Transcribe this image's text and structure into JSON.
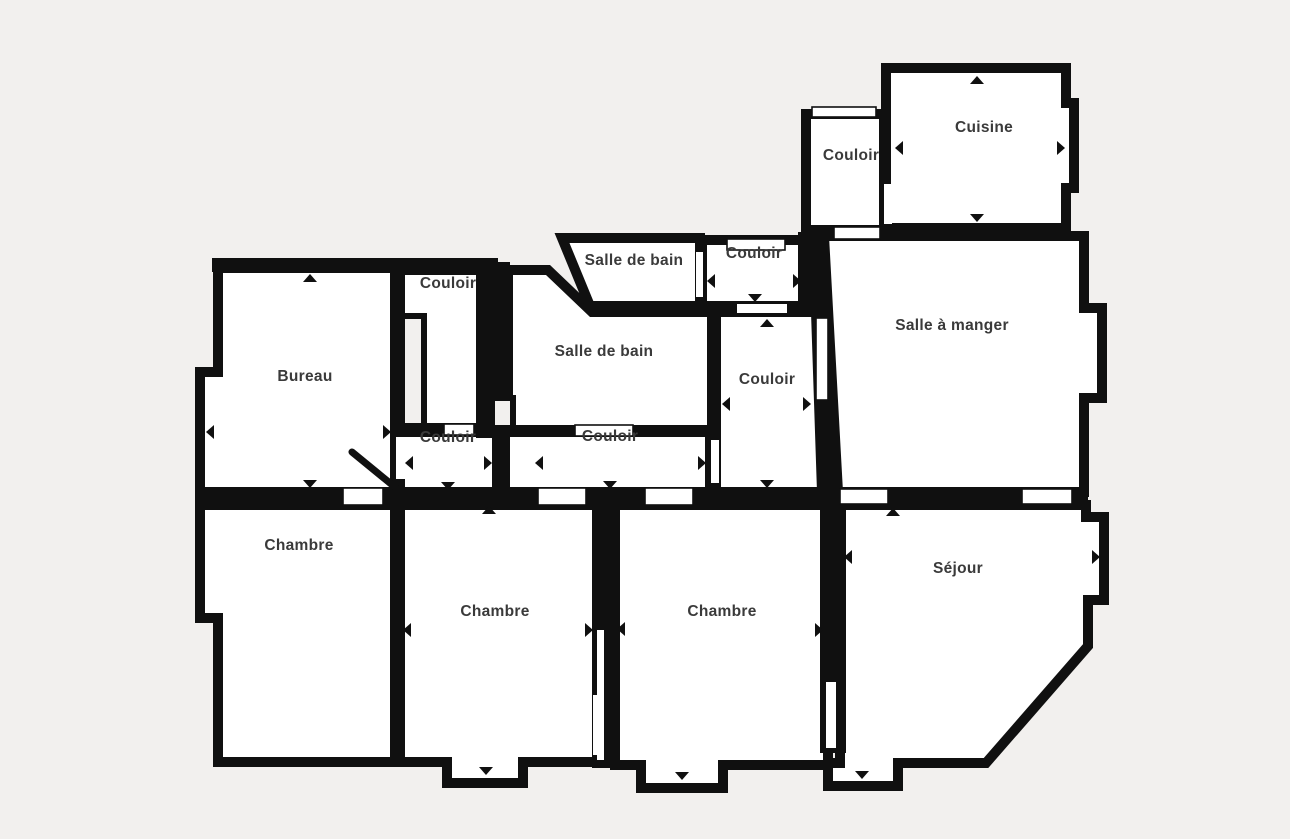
{
  "meta": {
    "app": "floor-plan-viewer",
    "plan_title": "Plan d'appartement"
  },
  "canvas": {
    "width": 1290,
    "height": 839,
    "bg_color": "#f2f0ee",
    "wall_color": "#101010",
    "room_fill": "#ffffff",
    "label_color": "#3a3a3a",
    "label_font_size": 15.5
  },
  "rooms": [
    {
      "id": "bureau",
      "label": "Bureau",
      "label_x": 305,
      "label_y": 377,
      "points": [
        [
          218,
          268
        ],
        [
          395,
          268
        ],
        [
          395,
          492
        ],
        [
          200,
          492
        ],
        [
          200,
          372
        ],
        [
          218,
          372
        ]
      ]
    },
    {
      "id": "couloir-topleft",
      "label": "Couloir",
      "label_x": 448,
      "label_y": 284,
      "points": [
        [
          400,
          270
        ],
        [
          483,
          270
        ],
        [
          483,
          428
        ],
        [
          400,
          428
        ]
      ]
    },
    {
      "id": "couloir-lower-left",
      "label": "Couloir",
      "label_x": 448,
      "label_y": 438,
      "points": [
        [
          400,
          432
        ],
        [
          497,
          432
        ],
        [
          497,
          492
        ],
        [
          400,
          492
        ]
      ]
    },
    {
      "id": "salle-de-bain-grande",
      "label": "Salle de bain",
      "label_x": 604,
      "label_y": 352,
      "points": [
        [
          508,
          270
        ],
        [
          548,
          270
        ],
        [
          592,
          312
        ],
        [
          712,
          312
        ],
        [
          712,
          430
        ],
        [
          508,
          430
        ]
      ]
    },
    {
      "id": "couloir-central",
      "label": "Couloir",
      "label_x": 610,
      "label_y": 437,
      "points": [
        [
          505,
          432
        ],
        [
          710,
          432
        ],
        [
          710,
          492
        ],
        [
          505,
          492
        ]
      ]
    },
    {
      "id": "salle-de-bain-petite",
      "label": "Salle de bain",
      "label_x": 634,
      "label_y": 261,
      "points": [
        [
          562,
          238
        ],
        [
          700,
          238
        ],
        [
          700,
          306
        ],
        [
          590,
          306
        ]
      ]
    },
    {
      "id": "couloir-haut-petit",
      "label": "Couloir",
      "label_x": 754,
      "label_y": 254,
      "points": [
        [
          702,
          240
        ],
        [
          806,
          240
        ],
        [
          806,
          306
        ],
        [
          702,
          306
        ]
      ]
    },
    {
      "id": "couloir-vertical",
      "label": "Couloir",
      "label_x": 767,
      "label_y": 380,
      "points": [
        [
          716,
          312
        ],
        [
          816,
          312
        ],
        [
          822,
          492
        ],
        [
          716,
          492
        ]
      ]
    },
    {
      "id": "couloir-cuisine",
      "label": "Couloir",
      "label_x": 851,
      "label_y": 156,
      "points": [
        [
          806,
          114
        ],
        [
          884,
          114
        ],
        [
          884,
          230
        ],
        [
          806,
          230
        ]
      ]
    },
    {
      "id": "cuisine",
      "label": "Cuisine",
      "label_x": 984,
      "label_y": 128,
      "points": [
        [
          886,
          68
        ],
        [
          1066,
          68
        ],
        [
          1066,
          103
        ],
        [
          1074,
          103
        ],
        [
          1074,
          188
        ],
        [
          1066,
          188
        ],
        [
          1066,
          228
        ],
        [
          886,
          228
        ]
      ]
    },
    {
      "id": "salle-a-manger",
      "label": "Salle à manger",
      "label_x": 952,
      "label_y": 326,
      "points": [
        [
          824,
          236
        ],
        [
          1084,
          236
        ],
        [
          1084,
          308
        ],
        [
          1102,
          308
        ],
        [
          1102,
          398
        ],
        [
          1084,
          398
        ],
        [
          1084,
          492
        ],
        [
          838,
          492
        ]
      ]
    },
    {
      "id": "chambre-gauche",
      "label": "Chambre",
      "label_x": 299,
      "label_y": 546,
      "points": [
        [
          200,
          505
        ],
        [
          395,
          505
        ],
        [
          395,
          762
        ],
        [
          218,
          762
        ],
        [
          218,
          618
        ],
        [
          200,
          618
        ]
      ]
    },
    {
      "id": "chambre-milieu",
      "label": "Chambre",
      "label_x": 495,
      "label_y": 612,
      "points": [
        [
          400,
          505
        ],
        [
          598,
          505
        ],
        [
          598,
          762
        ],
        [
          523,
          762
        ],
        [
          523,
          783
        ],
        [
          447,
          783
        ],
        [
          447,
          762
        ],
        [
          400,
          762
        ]
      ]
    },
    {
      "id": "chambre-droite",
      "label": "Chambre",
      "label_x": 722,
      "label_y": 612,
      "points": [
        [
          615,
          505
        ],
        [
          828,
          505
        ],
        [
          828,
          765
        ],
        [
          723,
          765
        ],
        [
          723,
          788
        ],
        [
          641,
          788
        ],
        [
          641,
          765
        ],
        [
          615,
          765
        ]
      ]
    },
    {
      "id": "sejour",
      "label": "Séjour",
      "label_x": 958,
      "label_y": 569,
      "points": [
        [
          840,
          505
        ],
        [
          1086,
          505
        ],
        [
          1086,
          517
        ],
        [
          1104,
          517
        ],
        [
          1104,
          600
        ],
        [
          1088,
          600
        ],
        [
          1088,
          646
        ],
        [
          986,
          763
        ],
        [
          898,
          763
        ],
        [
          898,
          786
        ],
        [
          828,
          786
        ],
        [
          828,
          763
        ],
        [
          840,
          763
        ]
      ]
    }
  ],
  "wall_patches": [
    {
      "points": [
        [
          476,
          262
        ],
        [
          510,
          262
        ],
        [
          510,
          438
        ],
        [
          476,
          438
        ]
      ]
    },
    {
      "points": [
        [
          212,
          258
        ],
        [
          498,
          258
        ],
        [
          498,
          272
        ],
        [
          212,
          272
        ]
      ]
    },
    {
      "points": [
        [
          195,
          487
        ],
        [
          840,
          487
        ],
        [
          840,
          507
        ],
        [
          195,
          507
        ]
      ]
    },
    {
      "points": [
        [
          818,
          306
        ],
        [
          832,
          306
        ],
        [
          842,
          494
        ],
        [
          822,
          494
        ]
      ]
    },
    {
      "points": [
        [
          798,
          232
        ],
        [
          828,
          232
        ],
        [
          828,
          310
        ],
        [
          798,
          310
        ]
      ]
    },
    {
      "points": [
        [
          592,
          498
        ],
        [
          618,
          498
        ],
        [
          618,
          768
        ],
        [
          592,
          768
        ]
      ]
    },
    {
      "points": [
        [
          820,
          498
        ],
        [
          846,
          498
        ],
        [
          846,
          753
        ],
        [
          820,
          753
        ]
      ]
    },
    {
      "points": [
        [
          833,
          487
        ],
        [
          1088,
          487
        ],
        [
          1088,
          507
        ],
        [
          833,
          507
        ]
      ]
    }
  ],
  "shafts": [
    {
      "x": 402,
      "y": 316,
      "w": 22,
      "h": 110
    },
    {
      "x": 492,
      "y": 398,
      "w": 21,
      "h": 30
    }
  ],
  "door_openings": [
    {
      "x": 727,
      "y": 239,
      "w": 58,
      "h": 11,
      "outlined": true
    },
    {
      "x": 834,
      "y": 227,
      "w": 46,
      "h": 12,
      "outlined": true
    },
    {
      "x": 884,
      "y": 184,
      "w": 8,
      "h": 40,
      "outlined": false
    },
    {
      "x": 816,
      "y": 318,
      "w": 12,
      "h": 82,
      "outlined": true
    },
    {
      "x": 711,
      "y": 440,
      "w": 8,
      "h": 43,
      "outlined": false
    },
    {
      "x": 696,
      "y": 252,
      "w": 7,
      "h": 45,
      "outlined": false
    },
    {
      "x": 737,
      "y": 304,
      "w": 50,
      "h": 9,
      "outlined": false
    },
    {
      "x": 840,
      "y": 489,
      "w": 48,
      "h": 15,
      "outlined": true
    },
    {
      "x": 1022,
      "y": 489,
      "w": 50,
      "h": 15,
      "outlined": true
    },
    {
      "x": 343,
      "y": 488,
      "w": 40,
      "h": 17,
      "outlined": true
    },
    {
      "x": 538,
      "y": 488,
      "w": 48,
      "h": 17,
      "outlined": true
    },
    {
      "x": 645,
      "y": 488,
      "w": 48,
      "h": 17,
      "outlined": true
    },
    {
      "x": 396,
      "y": 437,
      "w": 9,
      "h": 42,
      "outlined": false
    },
    {
      "x": 444,
      "y": 424,
      "w": 30,
      "h": 11,
      "outlined": true
    },
    {
      "x": 575,
      "y": 425,
      "w": 58,
      "h": 11,
      "outlined": true
    },
    {
      "x": 593,
      "y": 695,
      "w": 11,
      "h": 60,
      "outlined": false
    },
    {
      "x": 597,
      "y": 630,
      "w": 7,
      "h": 130,
      "outlined": false
    },
    {
      "x": 826,
      "y": 682,
      "w": 10,
      "h": 66,
      "outlined": false
    },
    {
      "x": 812,
      "y": 107,
      "w": 64,
      "h": 10,
      "outlined": true
    }
  ],
  "door_arrows": [
    {
      "x": 977,
      "y": 80,
      "dir": "up"
    },
    {
      "x": 899,
      "y": 148,
      "dir": "left"
    },
    {
      "x": 1061,
      "y": 148,
      "dir": "right"
    },
    {
      "x": 977,
      "y": 218,
      "dir": "down"
    },
    {
      "x": 711,
      "y": 281,
      "dir": "left"
    },
    {
      "x": 797,
      "y": 281,
      "dir": "right"
    },
    {
      "x": 755,
      "y": 298,
      "dir": "down"
    },
    {
      "x": 767,
      "y": 323,
      "dir": "up"
    },
    {
      "x": 726,
      "y": 404,
      "dir": "left"
    },
    {
      "x": 807,
      "y": 404,
      "dir": "right"
    },
    {
      "x": 767,
      "y": 484,
      "dir": "down"
    },
    {
      "x": 539,
      "y": 463,
      "dir": "left"
    },
    {
      "x": 702,
      "y": 463,
      "dir": "right"
    },
    {
      "x": 610,
      "y": 485,
      "dir": "down"
    },
    {
      "x": 409,
      "y": 463,
      "dir": "left"
    },
    {
      "x": 488,
      "y": 463,
      "dir": "right"
    },
    {
      "x": 448,
      "y": 486,
      "dir": "down"
    },
    {
      "x": 310,
      "y": 278,
      "dir": "up"
    },
    {
      "x": 210,
      "y": 432,
      "dir": "left"
    },
    {
      "x": 387,
      "y": 432,
      "dir": "right"
    },
    {
      "x": 310,
      "y": 484,
      "dir": "down"
    },
    {
      "x": 489,
      "y": 510,
      "dir": "up"
    },
    {
      "x": 407,
      "y": 630,
      "dir": "left"
    },
    {
      "x": 589,
      "y": 630,
      "dir": "right"
    },
    {
      "x": 486,
      "y": 771,
      "dir": "down"
    },
    {
      "x": 621,
      "y": 629,
      "dir": "left"
    },
    {
      "x": 819,
      "y": 630,
      "dir": "right"
    },
    {
      "x": 682,
      "y": 776,
      "dir": "down"
    },
    {
      "x": 893,
      "y": 512,
      "dir": "up"
    },
    {
      "x": 848,
      "y": 557,
      "dir": "left"
    },
    {
      "x": 1096,
      "y": 557,
      "dir": "right"
    },
    {
      "x": 862,
      "y": 775,
      "dir": "down"
    }
  ],
  "door_swings": [
    {
      "x1": 352,
      "y1": 452,
      "x2": 396,
      "y2": 488
    }
  ]
}
